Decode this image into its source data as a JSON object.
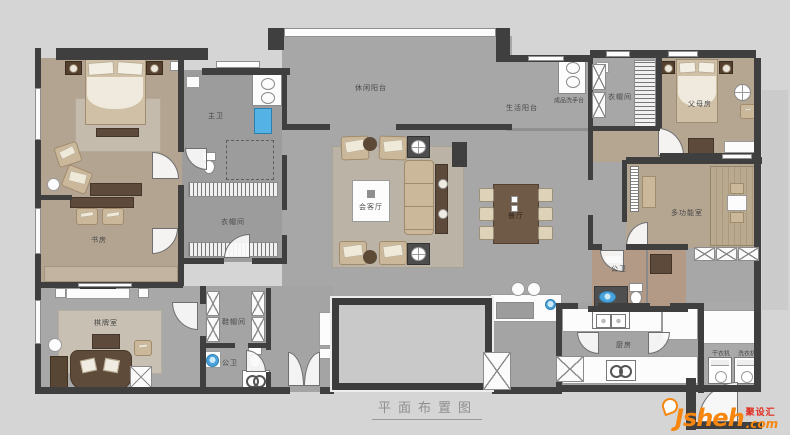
{
  "title": {
    "text": "平面布置图"
  },
  "rooms": {
    "master_bath": "主卫",
    "study": "书房",
    "closet_left": "衣帽间",
    "leisure_balcony": "休闲阳台",
    "living_room": "会客厅",
    "service_balcony": "生活阳台",
    "washstand": "成品洗手台",
    "closet_right": "衣帽间",
    "parents_room": "父母房",
    "multi_function_room": "多功能室",
    "bath_right": "公卫",
    "dining_room": "餐厅",
    "game_room": "棋牌室",
    "shoe_room": "鞋帽间",
    "bath_entry": "公卫",
    "kitchen": "厨房",
    "dryer": "干衣机",
    "washer": "洗衣机"
  },
  "watermark": {
    "brand": "Jsheh",
    "tld": ".com",
    "cn": "聚设汇"
  },
  "colors": {
    "wall": "#3f3f3f",
    "floor_public": "#a7a7a7",
    "floor_bedroom": "#b3a492",
    "accent_blue": "#4aa3dc",
    "brand_orange": "#f6860e",
    "brand_red": "#e02b1e"
  }
}
